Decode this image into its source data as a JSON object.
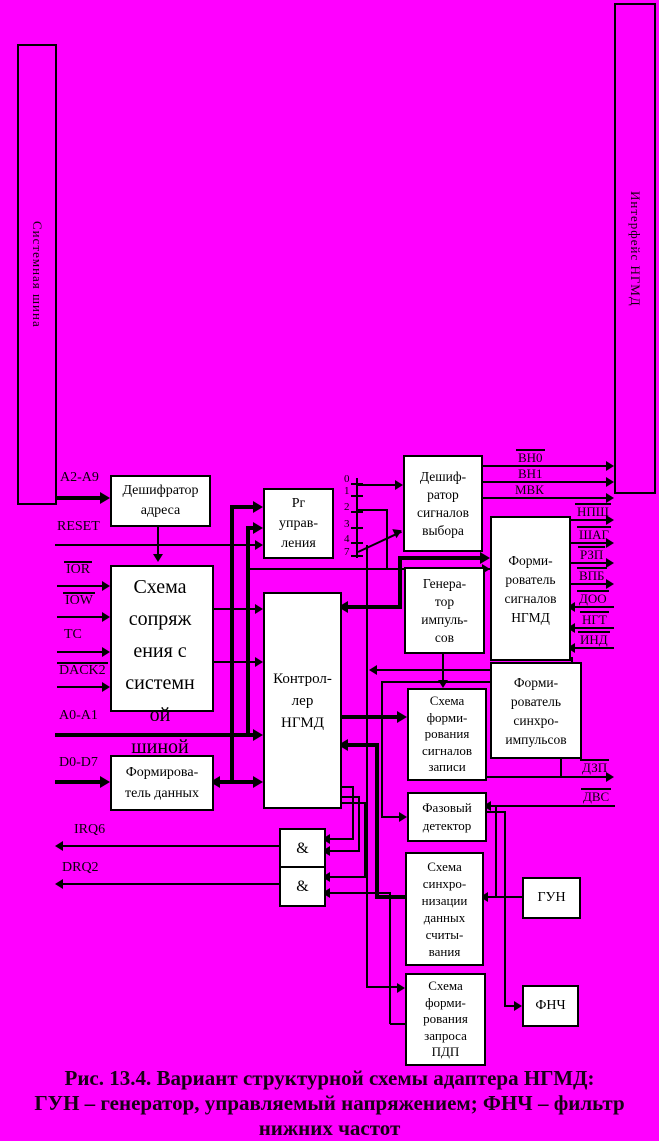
{
  "colors": {
    "background": "#FF00FF",
    "line": "#000000",
    "box_fill": "#FFFFFF"
  },
  "buses": {
    "system": {
      "label": "Системная шина"
    },
    "interface": {
      "label": "Интерфейс НГМД"
    }
  },
  "blocks": {
    "addr_decoder": {
      "label": "Дешифратор\nадреса"
    },
    "bus_interface": {
      "label": "Схема\nсопряж\nения с\nсистемн\nой\nшиной"
    },
    "data_former": {
      "label": "Формирова-\nтель данных"
    },
    "ctrl_reg": {
      "label": "Рг\nуправ-\nления"
    },
    "fdc": {
      "label": "Контрол-\nлер\nНГМД"
    },
    "select_decoder": {
      "label": "Дешиф-\nратор\nсигналов\nвыбора"
    },
    "pulse_gen": {
      "label": "Генера-\nтор\nимпуль-\nсов"
    },
    "signal_former": {
      "label": "Форми-\nрователь\nсигналов\nНГМД"
    },
    "sync_former": {
      "label": "Форми-\nрователь\nсинхро-\nимпульсов"
    },
    "write_former": {
      "label": "Схема\nформи-\nрования\nсигналов\nзаписи"
    },
    "phase_det": {
      "label": "Фазовый\nдетектор"
    },
    "read_sync": {
      "label": "Схема\nсинхро-\nнизации\nданных\nсчиты-\nвания"
    },
    "vco": {
      "label": "ГУН"
    },
    "lpf": {
      "label": "ФНЧ"
    },
    "dma_req": {
      "label": "Схема\nформи-\nрования\nзапроса\nПДП"
    }
  },
  "gates": [
    {
      "label": "&"
    },
    {
      "label": "&"
    }
  ],
  "left_signals": [
    {
      "label": "А2-А9"
    },
    {
      "label": "RESET"
    },
    {
      "label": "IOR"
    },
    {
      "label": "IOW"
    },
    {
      "label": "ТС"
    },
    {
      "label": "DACK2"
    },
    {
      "label": "А0-А1"
    },
    {
      "label": "D0-D7"
    },
    {
      "label": "IRQ6"
    },
    {
      "label": "DRQ2"
    }
  ],
  "right_signals": [
    {
      "label": "ВН0"
    },
    {
      "label": "ВН1"
    },
    {
      "label": "МВК"
    },
    {
      "label": "НПШ"
    },
    {
      "label": "ШАГ"
    },
    {
      "label": "РЗП"
    },
    {
      "label": "ВПБ"
    },
    {
      "label": "ДОО"
    },
    {
      "label": "НГТ"
    },
    {
      "label": "ИНД"
    },
    {
      "label": "ДЗП"
    },
    {
      "label": "ДВС"
    }
  ],
  "register_bits": [
    "0",
    "1",
    "2",
    "3",
    "4",
    "7"
  ],
  "caption": {
    "line1": "Рис. 13.4. Вариант структурной схемы адаптера НГМД:",
    "line2": "ГУН – генератор, управляемый напряжением; ФНЧ – фильтр нижних частот"
  }
}
